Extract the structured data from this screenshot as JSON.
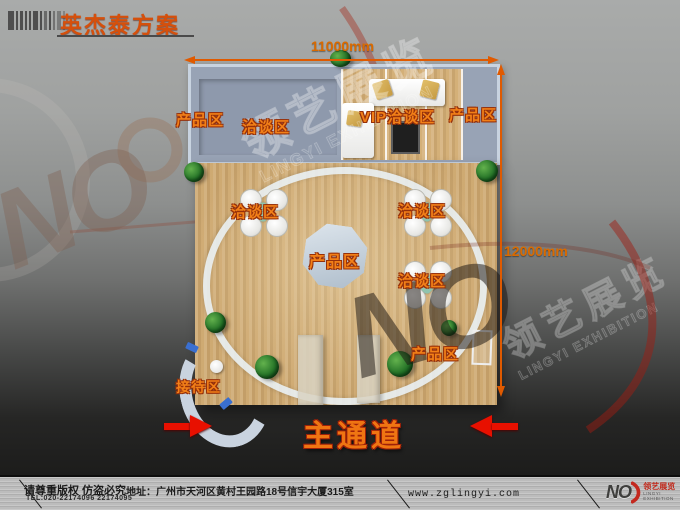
{
  "header": {
    "title": "英杰泰方案"
  },
  "dimensions": {
    "top": "11000mm",
    "right": "12000mm"
  },
  "plan": {
    "areas": {
      "product_top_left": "产品区",
      "meeting_top": "洽谈区",
      "vip_meeting": "VIP洽谈区",
      "product_top_right": "产品区",
      "meeting_left": "洽谈区",
      "meeting_right_upper": "洽谈区",
      "meeting_right_lower": "洽谈区",
      "product_center": "产品区",
      "product_bottom_right": "产品区",
      "reception": "接待区",
      "main_aisle": "主通道"
    }
  },
  "watermark": {
    "no": "NO",
    "brand_cn": "领艺展览",
    "brand_en": "LINGYI EXHIBITION"
  },
  "footer": {
    "copyright": "请尊重版权 仿盗必究",
    "tel": "TEL:020-22174096 22174095",
    "address": "地址：广州市天河区黄村王园路18号信宇大厦315室",
    "website": "www.zglingyi.com",
    "logo_no": "NO",
    "logo_cn": "领艺展览",
    "logo_en": "LINGYI EXHIBITION"
  },
  "colors": {
    "accent_orange": "#e8650a",
    "dimension_orange": "#e05a00",
    "arrow_red": "#e81000",
    "wood": "#cda76e",
    "room_blue": "#98a3b5",
    "ring_white": "#e9f1f6"
  }
}
